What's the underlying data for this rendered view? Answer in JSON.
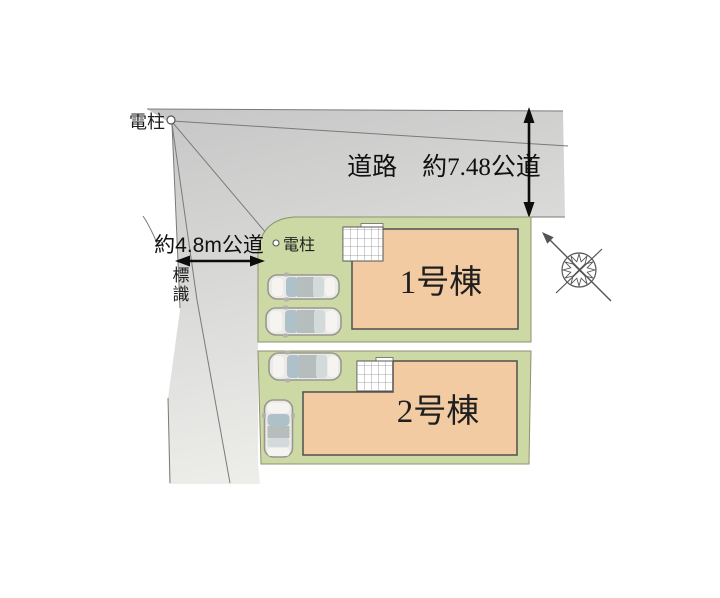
{
  "site_plan": {
    "utility_pole_top": "電柱",
    "utility_pole_plot": "電柱",
    "main_road_label": "道路　約7.48公道",
    "side_road_label": "約4.8m公道",
    "sign_label": "標識",
    "building_1_label": "1号棟",
    "building_2_label": "2号棟"
  },
  "colors": {
    "plot_green": "#ccd9a5",
    "building_fill": "#f2cba3",
    "road_dark": "#c7c7c7",
    "road_light": "#efefec",
    "divider_white": "#ffffff"
  }
}
